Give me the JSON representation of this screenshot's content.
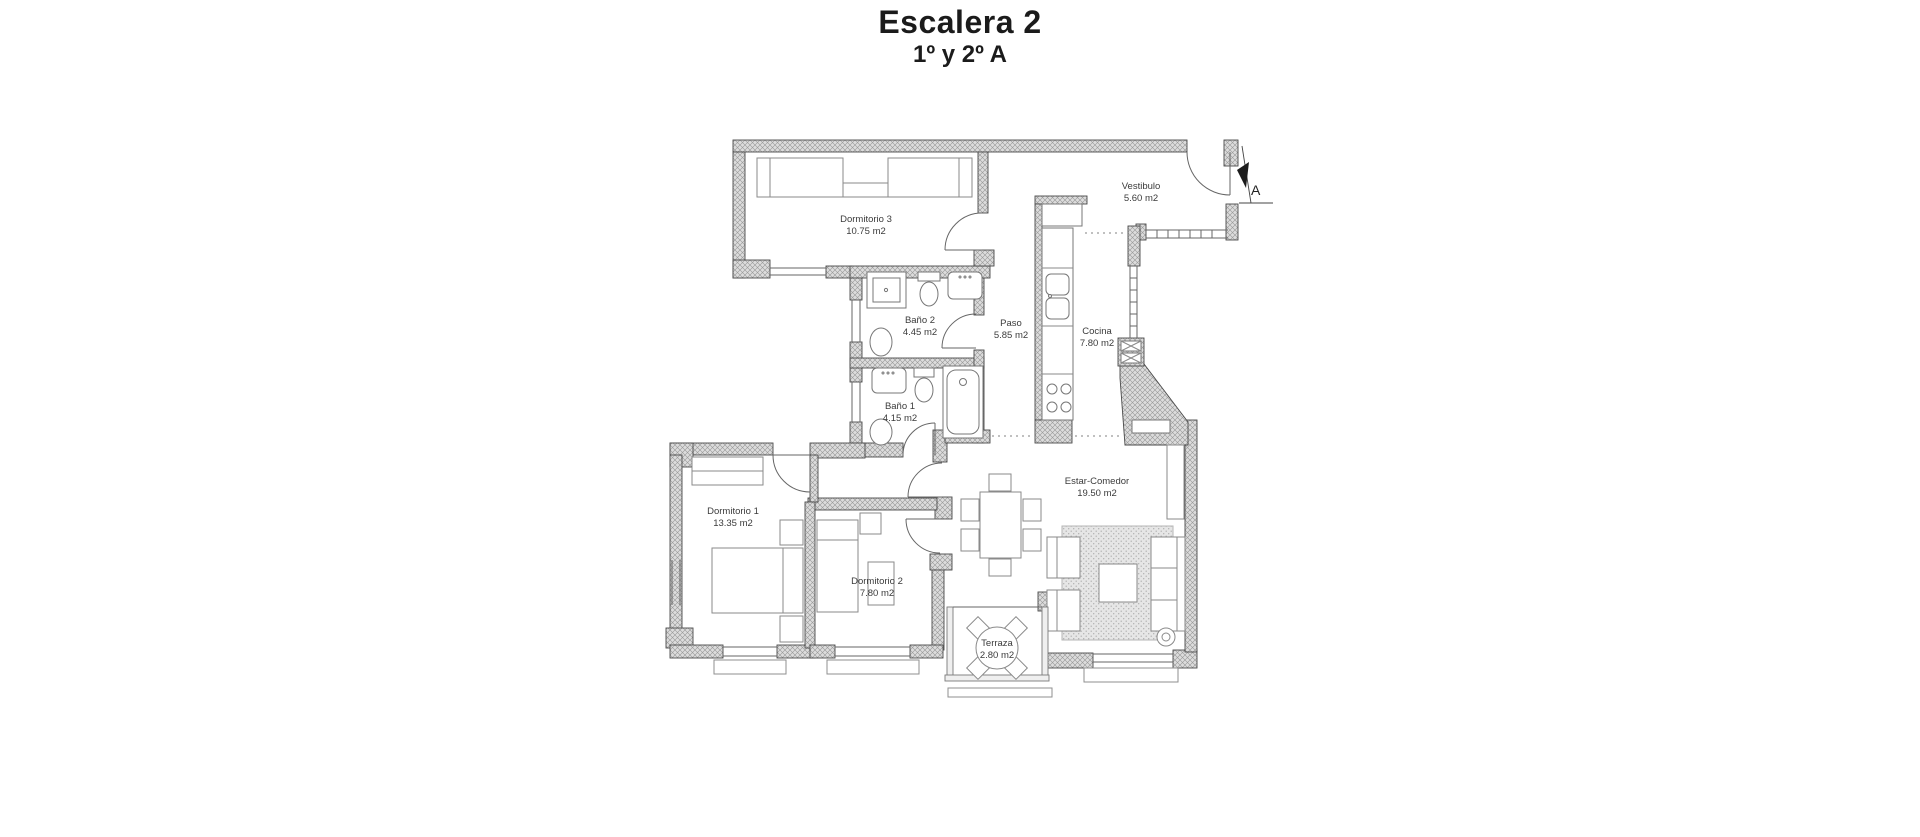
{
  "header": {
    "title": "Escalera 2",
    "subtitle": "1º y 2º A"
  },
  "plan": {
    "entrance_label": "A",
    "rooms": {
      "dormitorio3": {
        "name": "Dormitorio 3",
        "area": "10.75 m2"
      },
      "vestibulo": {
        "name": "Vestibulo",
        "area": "5.60 m2"
      },
      "bano2": {
        "name": "Baño 2",
        "area": "4.45 m2"
      },
      "paso": {
        "name": "Paso",
        "area": "5.85 m2"
      },
      "cocina": {
        "name": "Cocina",
        "area": "7.80 m2"
      },
      "bano1": {
        "name": "Baño 1",
        "area": "4.15 m2"
      },
      "estar_comedor": {
        "name": "Estar-Comedor",
        "area": "19.50 m2"
      },
      "dormitorio1": {
        "name": "Dormitorio 1",
        "area": "13.35 m2"
      },
      "dormitorio2": {
        "name": "Dormitorio 2",
        "area": "7.80 m2"
      },
      "terraza": {
        "name": "Terraza",
        "area": "2.80 m2"
      }
    },
    "colors": {
      "wall_fill": "#dcdcdc",
      "wall_hatch": "#979797",
      "line": "#666666",
      "text": "#3b3b3b"
    }
  }
}
